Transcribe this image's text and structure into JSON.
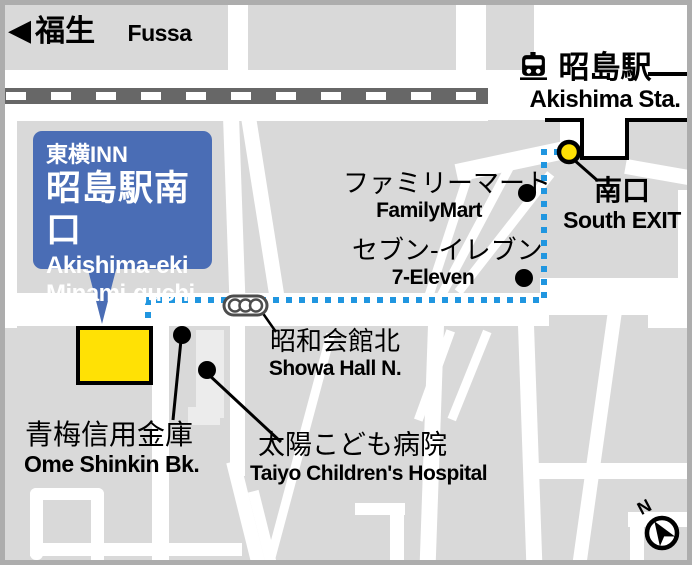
{
  "map_title": "Toyoko INN Akishima-eki Minami-guchi access map",
  "direction_sign": {
    "arrow": "◀",
    "jp": "福生",
    "en": "Fussa"
  },
  "station": {
    "jp": "昭島駅",
    "en": "Akishima Sta."
  },
  "south_exit": {
    "jp": "南口",
    "en": "South EXIT"
  },
  "hotel": {
    "brand": "東横INN",
    "name_jp": "昭島駅南口",
    "name_en1": "Akishima-eki",
    "name_en2": "Minami-guchi"
  },
  "pois": {
    "familymart": {
      "jp": "ファミリーマート",
      "en": "FamilyMart"
    },
    "seven_eleven": {
      "jp": "セブン-イレブン",
      "en": "7-Eleven"
    },
    "showa_hall": {
      "jp": "昭和会館北",
      "en": "Showa Hall N."
    },
    "ome_shinkin": {
      "jp": "青梅信用金庫",
      "en": "Ome Shinkin Bk."
    },
    "taiyo_hospital": {
      "jp": "太陽こども病院",
      "en": "Taiyo Children's Hospital"
    }
  },
  "compass": {
    "label": "N"
  },
  "icons": {
    "train": "train-icon",
    "traffic_light": "traffic-light-icon",
    "west_arrow": "west-arrow-icon",
    "compass_north": "compass-north-icon"
  },
  "colors": {
    "map_background": "#d9d9d9",
    "road_white": "#ffffff",
    "railway_gray": "#676767",
    "hotel_callout_blue": "#4a6db5",
    "hotel_marker_yellow": "#ffe105",
    "route_blue": "#2096e0",
    "building_light": "#ececec",
    "frame_gray": "#adadad",
    "text_black": "#000000"
  }
}
